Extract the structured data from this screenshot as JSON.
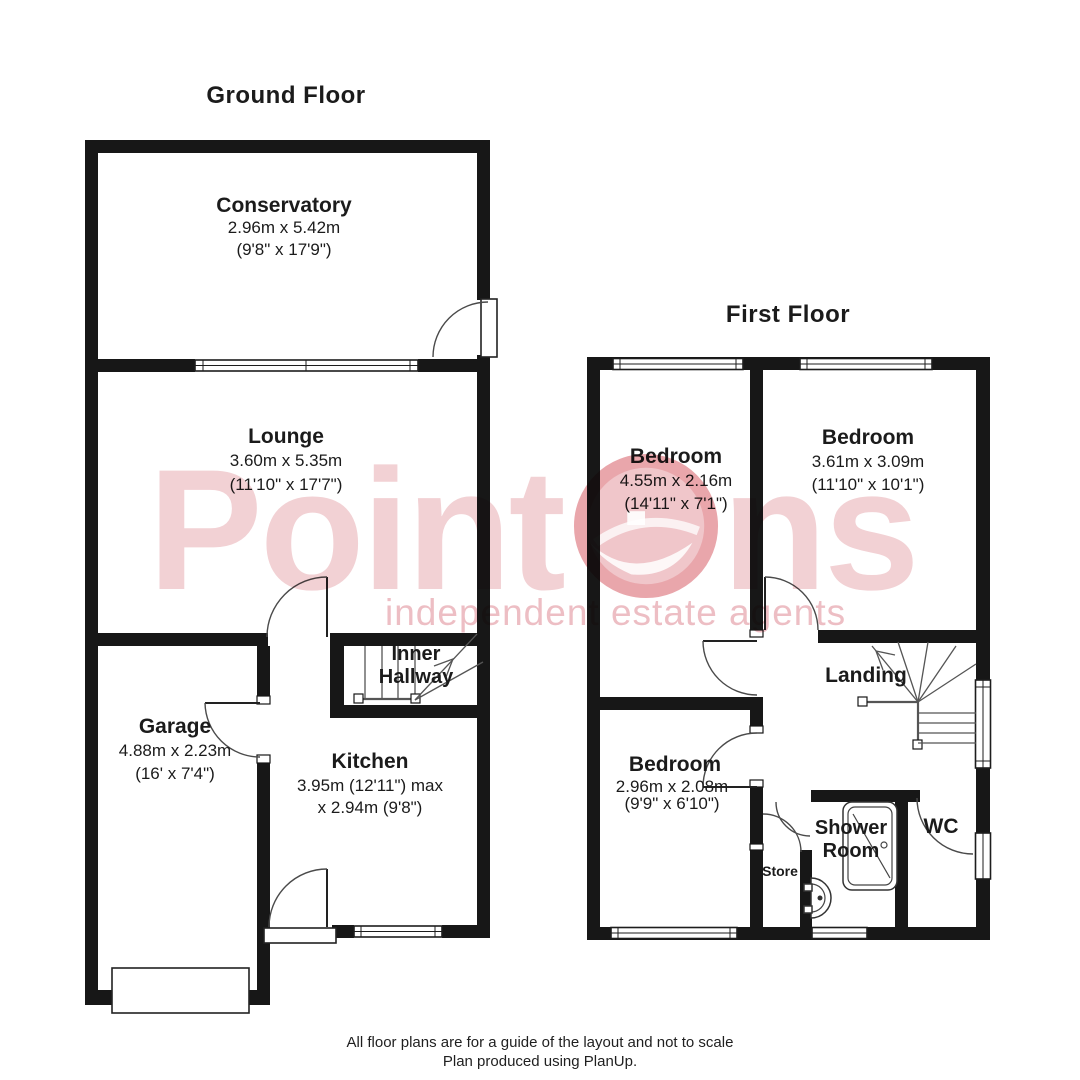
{
  "ground_floor": {
    "title": "Ground Floor",
    "rooms": [
      {
        "name": "Conservatory",
        "metric": "2.96m x 5.42m",
        "imperial": "(9'8\" x 17'9\")"
      },
      {
        "name": "Lounge",
        "metric": "3.60m x 5.35m",
        "imperial": "(11'10\" x 17'7\")"
      },
      {
        "name": "Inner Hallway"
      },
      {
        "name": "Garage",
        "metric": "4.88m x 2.23m",
        "imperial": "(16' x 7'4\")"
      },
      {
        "name": "Kitchen",
        "metric": "3.95m (12'11\") max",
        "imperial": "x 2.94m (9'8\")"
      }
    ]
  },
  "first_floor": {
    "title": "First Floor",
    "rooms": [
      {
        "name": "Bedroom",
        "metric": "4.55m x 2.16m",
        "imperial": "(14'11\" x 7'1\")"
      },
      {
        "name": "Bedroom",
        "metric": "3.61m x 3.09m",
        "imperial": "(11'10\" x 10'1\")"
      },
      {
        "name": "Bedroom",
        "metric": "2.96m x 2.08m",
        "imperial": "(9'9\" x 6'10\")"
      },
      {
        "name": "Landing"
      },
      {
        "name": "Shower Room"
      },
      {
        "name": "WC"
      },
      {
        "name": "Store"
      }
    ]
  },
  "watermark": {
    "brand_pre": "Point",
    "brand_post": "ns",
    "tagline": "independent estate agents",
    "text_color": "#f2d1d4",
    "tagline_color": "#edbec4",
    "logo_color": "#e9a6ab"
  },
  "footer": {
    "line1": "All floor plans are for a guide of the layout and not to scale",
    "line2": "Plan produced using PlanUp."
  }
}
